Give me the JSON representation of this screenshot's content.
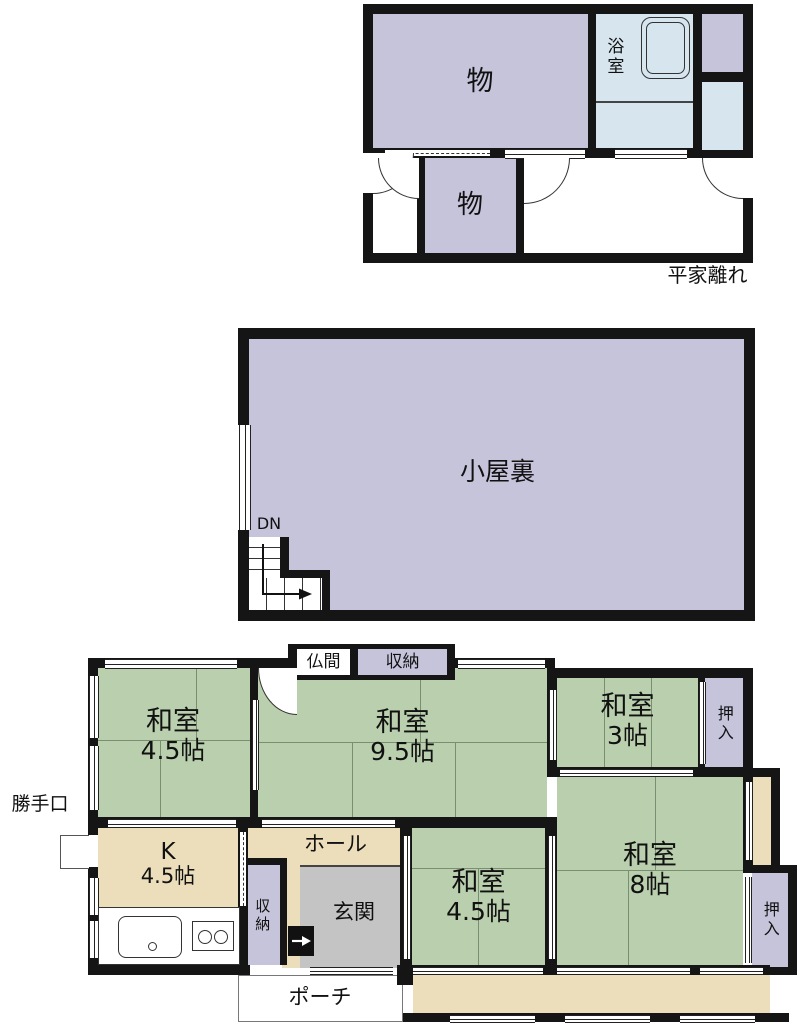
{
  "colors": {
    "wall": "#151515",
    "tatami": "#b9cfad",
    "storage": "#c6c4db",
    "bath": "#d7e5ee",
    "wood": "#ecdeba",
    "entry": "#c4c4c4"
  },
  "annex": {
    "caption": "平家離れ",
    "storage_main": "物",
    "storage_small": "物",
    "bath": "浴室"
  },
  "attic": {
    "room": "小屋裏",
    "stairs": "DN"
  },
  "main": {
    "washitsu_nw": {
      "name": "和室",
      "size": "4.5帖"
    },
    "washitsu_center": {
      "name": "和室",
      "size": "9.5帖"
    },
    "washitsu_ne": {
      "name": "和室",
      "size": "3帖"
    },
    "washitsu_e": {
      "name": "和室",
      "size": "8帖"
    },
    "washitsu_s": {
      "name": "和室",
      "size": "4.5帖"
    },
    "kitchen": {
      "name": "K",
      "size": "4.5帖"
    },
    "hall": "ホール",
    "entrance": "玄関",
    "butsuma": "仏間",
    "closet_top": "収納",
    "closet_entry": "収納",
    "oshiire_ne": "押入",
    "oshiire_se": "押入",
    "porch": "ポーチ",
    "back_door": "勝手口"
  }
}
